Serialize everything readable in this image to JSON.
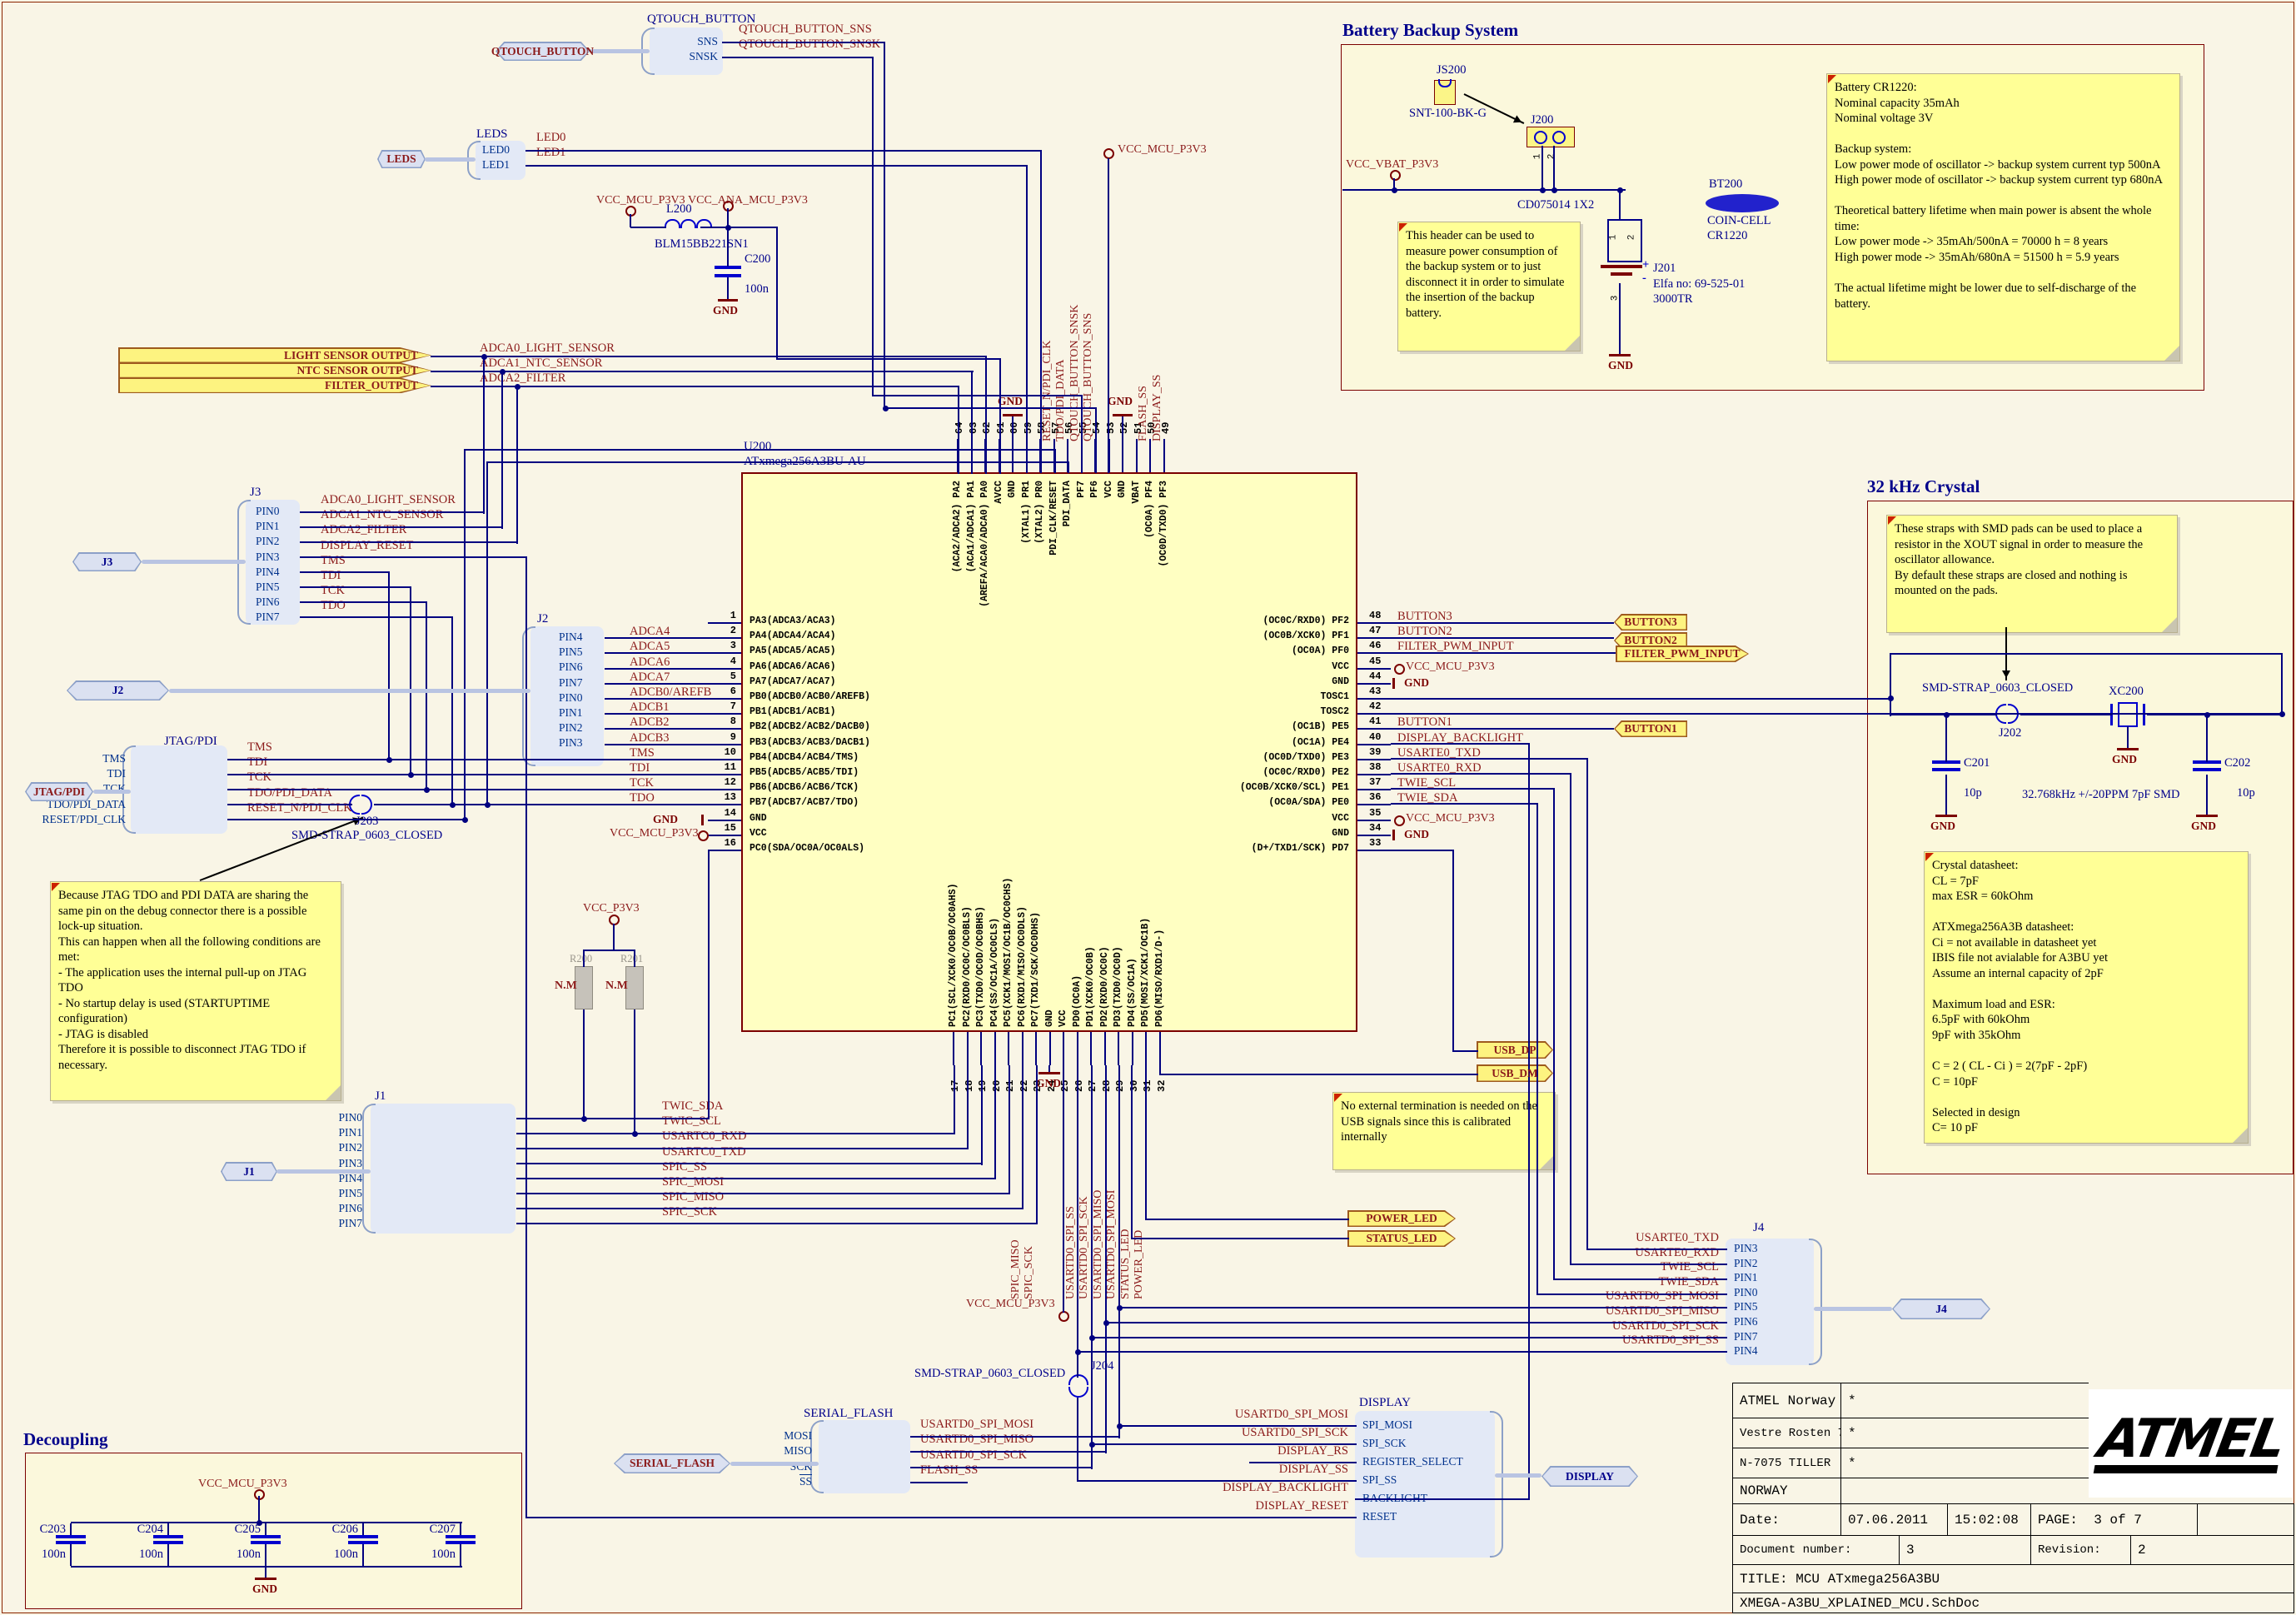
{
  "nets": {
    "vcc_mcu": "VCC_MCU_P3V3",
    "vcc_ana": "VCC_ANA_MCU_P3V3",
    "vcc_vbat": "VCC_VBAT_P3V3",
    "vcc_p3v3": "VCC_P3V3",
    "gnd": "GND",
    "qtouch_sns": "QTOUCH_BUTTON_SNS",
    "qtouch_snsk": "QTOUCH_BUTTON_SNSK",
    "led0": "LED0",
    "led1": "LED1"
  },
  "sections": {
    "battery_title": "Battery Backup System",
    "crystal_title": "32 kHz Crystal",
    "decoupling_title": "Decoupling"
  },
  "qtouch": {
    "port": "QTOUCH_BUTTON",
    "title": "QTOUCH_BUTTON",
    "rows": [
      {
        "pin": "SNS",
        "net": "QTOUCH_BUTTON_SNS"
      },
      {
        "pin": "SNSK",
        "net": "QTOUCH_BUTTON_SNSK"
      }
    ]
  },
  "leds": {
    "port": "LEDS",
    "title": "LEDS",
    "rows": [
      {
        "pin": "LED0",
        "net": "LED0"
      },
      {
        "pin": "LED1",
        "net": "LED1"
      }
    ]
  },
  "ana": {
    "l_ref": "L200",
    "l_val": "BLM15BB221SN1",
    "c_ref": "C200",
    "c_val": "100n"
  },
  "battery": {
    "js200_ref": "JS200",
    "js200_val": "SNT-100-BK-G",
    "j200_ref": "J200",
    "j200_val": "CD075014 1X2",
    "j200_p1": "1",
    "j200_p2": "2",
    "j201_ref": "J201",
    "j201_val1": "Elfa no: 69-525-01",
    "j201_val2": "3000TR",
    "j201_p1": "1",
    "j201_p2": "2",
    "j201_p3": "3",
    "plus": "+",
    "minus": "-",
    "bt200_ref": "BT200",
    "bt200_val1": "COIN-CELL",
    "bt200_val2": "CR1220",
    "note_header": "This header can be used to measure power consumption of the backup system or to just disconnect it in order to simulate the insertion of the backup battery.",
    "note_battery": "Battery CR1220:\nNominal capacity 35mAh\nNominal voltage 3V\n\nBackup system:\nLow power mode of oscillator -> backup system current typ 500nA\nHigh power mode of oscillator -> backup system current typ 680nA\n\nTheoretical battery lifetime when main power is absent the whole time:\nLow power mode -> 35mAh/500nA = 70000 h = 8 years\nHigh power mode -> 35mAh/680nA = 51500 h = 5.9 years\n\nThe actual lifetime might be lower due to self-discharge of the battery."
  },
  "sensor_ports": {
    "rows": [
      {
        "label": "LIGHT SENSOR OUTPUT",
        "net": "ADCA0_LIGHT_SENSOR"
      },
      {
        "label": "NTC SENSOR OUTPUT",
        "net": "ADCA1_NTC_SENSOR"
      },
      {
        "label": "FILTER_OUTPUT",
        "net": "ADCA2_FILTER"
      }
    ]
  },
  "j3": {
    "title": "J3",
    "port": "J3",
    "rows": [
      {
        "pin": "PIN0",
        "net": "ADCA0_LIGHT_SENSOR"
      },
      {
        "pin": "PIN1",
        "net": "ADCA1_NTC_SENSOR"
      },
      {
        "pin": "PIN2",
        "net": "ADCA2_FILTER"
      },
      {
        "pin": "PIN3",
        "net": "DISPLAY_RESET"
      },
      {
        "pin": "PIN4",
        "net": "TMS"
      },
      {
        "pin": "PIN5",
        "net": "TDI"
      },
      {
        "pin": "PIN6",
        "net": "TCK"
      },
      {
        "pin": "PIN7",
        "net": "TDO"
      }
    ]
  },
  "j2": {
    "title": "J2",
    "port": "J2",
    "rows": [
      {
        "pin": "PIN4"
      },
      {
        "pin": "PIN5"
      },
      {
        "pin": "PIN6"
      },
      {
        "pin": "PIN7"
      },
      {
        "pin": "PIN0"
      },
      {
        "pin": "PIN1"
      },
      {
        "pin": "PIN2"
      },
      {
        "pin": "PIN3"
      }
    ]
  },
  "jtag": {
    "title": "JTAG/PDI",
    "port": "JTAG/PDI",
    "strap_ref": "J203",
    "strap_val": "SMD-STRAP_0603_CLOSED",
    "rows": [
      {
        "pin": "TMS",
        "net": "TMS"
      },
      {
        "pin": "TDI",
        "net": "TDI"
      },
      {
        "pin": "TCK",
        "net": "TCK"
      },
      {
        "pin": "TDO/PDI_DATA",
        "net": "TDO/PDI_DATA"
      },
      {
        "pin": "RESET/PDI_CLK",
        "net": "RESET_N/PDI_CLK"
      }
    ],
    "note": "Because JTAG TDO and PDI DATA are sharing the same pin on the debug connector there is a possible lock-up situation.\nThis can happen when all the following conditions are met:\n- The application uses the internal pull-up on JTAG TDO\n- No startup delay is used (STARTUPTIME configuration)\n- JTAG is disabled\nTherefore it is possible to disconnect JTAG TDO if necessary."
  },
  "mcu": {
    "ref": "U200",
    "part": "ATxmega256A3BU-AU",
    "left_pins": [
      {
        "num": "1",
        "name": "PA3(ADCA3/ACA3)",
        "net": ""
      },
      {
        "num": "2",
        "name": "PA4(ADCA4/ACA4)",
        "net": "ADCA4"
      },
      {
        "num": "3",
        "name": "PA5(ADCA5/ACA5)",
        "net": "ADCA5"
      },
      {
        "num": "4",
        "name": "PA6(ADCA6/ACA6)",
        "net": "ADCA6"
      },
      {
        "num": "5",
        "name": "PA7(ADCA7/ACA7)",
        "net": "ADCA7"
      },
      {
        "num": "6",
        "name": "PB0(ADCB0/ACB0/AREFB)",
        "net": "ADCB0/AREFB"
      },
      {
        "num": "7",
        "name": "PB1(ADCB1/ACB1)",
        "net": "ADCB1"
      },
      {
        "num": "8",
        "name": "PB2(ADCB2/ACB2/DACB0)",
        "net": "ADCB2"
      },
      {
        "num": "9",
        "name": "PB3(ADCB3/ACB3/DACB1)",
        "net": "ADCB3"
      },
      {
        "num": "10",
        "name": "PB4(ADCB4/ACB4/TMS)",
        "net": "TMS"
      },
      {
        "num": "11",
        "name": "PB5(ADCB5/ACB5/TDI)",
        "net": "TDI"
      },
      {
        "num": "12",
        "name": "PB6(ADCB6/ACB6/TCK)",
        "net": "TCK"
      },
      {
        "num": "13",
        "name": "PB7(ADCB7/ACB7/TDO)",
        "net": "TDO"
      },
      {
        "num": "14",
        "name": "GND",
        "net": "GND",
        "sym": "gnd"
      },
      {
        "num": "15",
        "name": "VCC",
        "net": "VCC_MCU_P3V3",
        "sym": "vcc"
      },
      {
        "num": "16",
        "name": "PC0(SDA/OC0A/OC0ALS)",
        "net": ""
      }
    ],
    "right_pins": [
      {
        "num": "48",
        "name": "(OC0C/RXD0) PF2",
        "net": "BUTTON3"
      },
      {
        "num": "47",
        "name": "(OC0B/XCK0) PF1",
        "net": "BUTTON2"
      },
      {
        "num": "46",
        "name": "(OC0A) PF0",
        "net": "FILTER_PWM_INPUT"
      },
      {
        "num": "45",
        "name": "VCC",
        "net": "VCC_MCU_P3V3",
        "sym": "vcc"
      },
      {
        "num": "44",
        "name": "GND",
        "net": "GND",
        "sym": "gnd"
      },
      {
        "num": "43",
        "name": "TOSC1",
        "net": ""
      },
      {
        "num": "42",
        "name": "TOSC2",
        "net": ""
      },
      {
        "num": "41",
        "name": "(OC1B) PE5",
        "net": "BUTTON1"
      },
      {
        "num": "40",
        "name": "(OC1A) PE4",
        "net": "DISPLAY_BACKLIGHT"
      },
      {
        "num": "39",
        "name": "(OC0D/TXD0) PE3",
        "net": "USARTE0_TXD"
      },
      {
        "num": "38",
        "name": "(OC0C/RXD0) PE2",
        "net": "USARTE0_RXD"
      },
      {
        "num": "37",
        "name": "(OC0B/XCK0/SCL) PE1",
        "net": "TWIE_SCL"
      },
      {
        "num": "36",
        "name": "(OC0A/SDA) PE0",
        "net": "TWIE_SDA"
      },
      {
        "num": "35",
        "name": "VCC",
        "net": "VCC_MCU_P3V3",
        "sym": "vcc"
      },
      {
        "num": "34",
        "name": "GND",
        "net": "GND",
        "sym": "gnd"
      },
      {
        "num": "33",
        "name": "(D+/TXD1/SCK) PD7",
        "net": ""
      }
    ],
    "top_pins": [
      {
        "num": "64",
        "name": "(ACA2/ADCA2) PA2"
      },
      {
        "num": "63",
        "name": "(ACA1/ADCA1) PA1"
      },
      {
        "num": "62",
        "name": "(AREFA/ACA0/ADCA0) PA0"
      },
      {
        "num": "61",
        "name": "AVCC"
      },
      {
        "num": "60",
        "name": "GND"
      },
      {
        "num": "59",
        "name": "(XTAL1) PR1"
      },
      {
        "num": "58",
        "name": "(XTAL2) PR0"
      },
      {
        "num": "57",
        "name": "PDI_CLK/RESET"
      },
      {
        "num": "56",
        "name": "PDI_DATA"
      },
      {
        "num": "55",
        "name": "PF7"
      },
      {
        "num": "54",
        "name": "PF6"
      },
      {
        "num": "53",
        "name": "VCC"
      },
      {
        "num": "52",
        "name": "GND"
      },
      {
        "num": "51",
        "name": "VBAT"
      },
      {
        "num": "50",
        "name": "(OC0A) PF4"
      },
      {
        "num": "49",
        "name": "(OC0D/TXD0) PF3"
      }
    ],
    "bottom_pins": [
      {
        "num": "17",
        "name": "PC1(SCL/XCK0/OC0B/OC0AHS)"
      },
      {
        "num": "18",
        "name": "PC2(RXD0/OC0C/OC0BLS)"
      },
      {
        "num": "19",
        "name": "PC3(TXD0/OC0D/OC0BHS)"
      },
      {
        "num": "20",
        "name": "PC4(SS/OC1A/OC0CLS)"
      },
      {
        "num": "21",
        "name": "PC5(XCK1/MOSI/OC1B/OC0CHS)"
      },
      {
        "num": "22",
        "name": "PC6(RXD1/MISO/OC0DLS)"
      },
      {
        "num": "23",
        "name": "PC7(TXD1/SCK/OC0DHS)"
      },
      {
        "num": "24",
        "name": "GND"
      },
      {
        "num": "25",
        "name": "VCC"
      },
      {
        "num": "26",
        "name": "PD0(OC0A)"
      },
      {
        "num": "27",
        "name": "PD1(XCK0/OC0B)"
      },
      {
        "num": "28",
        "name": "PD2(RXD0/OC0C)"
      },
      {
        "num": "29",
        "name": "PD3(TXD0/OC0D)"
      },
      {
        "num": "30",
        "name": "PD4(SS/OC1A)"
      },
      {
        "num": "31",
        "name": "PD5(MOSI/XCK1/OC1B)"
      },
      {
        "num": "32",
        "name": "PD6(MISO/RXD1/D-)"
      }
    ],
    "top_nets": [
      {
        "net": "RESET_N/PDI_CLK",
        "col": 7
      },
      {
        "net": "TDO/PDI_DATA",
        "col": 8
      },
      {
        "net": "QTOUCH_BUTTON_SNSK",
        "col": 9
      },
      {
        "net": "QTOUCH_BUTTON_SNS",
        "col": 10
      },
      {
        "net": "FLASH_SS",
        "col": 14
      },
      {
        "net": "DISPLAY_SS",
        "col": 15
      }
    ],
    "bottom_nets": [
      {
        "net": "SPIC_MISO",
        "col": 5
      },
      {
        "net": "SPIC_SCK",
        "col": 6
      },
      {
        "net": "USARTD0_SPI_SS",
        "col": 9
      },
      {
        "net": "USARTD0_SPI_SCK",
        "col": 10
      },
      {
        "net": "USARTD0_SPI_MISO",
        "col": 11
      },
      {
        "net": "USARTD0_SPI_MOSI",
        "col": 12
      },
      {
        "net": "STATUS_LED",
        "col": 13
      },
      {
        "net": "POWER_LED",
        "col": 14
      }
    ]
  },
  "right_ports": {
    "button3": "BUTTON3",
    "button2": "BUTTON2",
    "filter": "FILTER_PWM_INPUT",
    "button1": "BUTTON1"
  },
  "crystal": {
    "note_straps": "These straps with SMD pads can be used to place a resistor in the XOUT signal in order to measure the oscillator allowance.\nBy default these straps are closed and nothing is mounted on the pads.",
    "strap_val": "SMD-STRAP_0603_CLOSED",
    "strap_ref": "J202",
    "xtal_ref": "XC200",
    "xtal_val": "32.768kHz +/-20PPM 7pF  SMD",
    "c201_ref": "C201",
    "c201_val": "10p",
    "c202_ref": "C202",
    "c202_val": "10p",
    "note_datasheet": "Crystal datasheet:\nCL = 7pF\nmax ESR = 60kOhm\n\nATXmega256A3B datasheet:\nCi = not available in datasheet yet\nIBIS file not avialable for A3BU yet\nAssume an internal capacity of 2pF\n\nMaximum load and ESR:\n6.5pF with 60kOhm\n9pF with 35kOhm\n\nC = 2 ( CL - Ci ) = 2(7pF - 2pF)\nC = 10pF\n\nSelected in design\nC= 10 pF"
  },
  "usb": {
    "dp": "USB_DP",
    "dm": "USB_DM",
    "note": "No external termination is needed on the USB signals since this is calibrated internally"
  },
  "led_ports": {
    "power": "POWER_LED",
    "status": "STATUS_LED"
  },
  "j4": {
    "title": "J4",
    "port": "J4",
    "rows": [
      {
        "net": "USARTE0_TXD",
        "pin": "PIN3"
      },
      {
        "net": "USARTE0_RXD",
        "pin": "PIN2"
      },
      {
        "net": "TWIE_SCL",
        "pin": "PIN1"
      },
      {
        "net": "TWIE_SDA",
        "pin": "PIN0"
      },
      {
        "net": "USARTD0_SPI_MOSI",
        "pin": "PIN5"
      },
      {
        "net": "USARTD0_SPI_MISO",
        "pin": "PIN6"
      },
      {
        "net": "USARTD0_SPI_SCK",
        "pin": "PIN7"
      },
      {
        "net": "USARTD0_SPI_SS",
        "pin": "PIN4"
      }
    ]
  },
  "serial_flash": {
    "title": "SERIAL_FLASH",
    "port": "SERIAL_FLASH",
    "strap_ref": "J204",
    "strap_val": "SMD-STRAP_0603_CLOSED",
    "rows": [
      {
        "pin": "MOSI",
        "net": "USARTD0_SPI_MOSI"
      },
      {
        "pin": "MISO",
        "net": "USARTD0_SPI_MISO"
      },
      {
        "pin": "SCK",
        "net": "USARTD0_SPI_SCK"
      },
      {
        "pin": "SS",
        "net": "FLASH_SS",
        "bar": true
      }
    ]
  },
  "display": {
    "title": "DISPLAY",
    "port": "DISPLAY",
    "rows": [
      {
        "pin": "SPI_MOSI",
        "net": "USARTD0_SPI_MOSI"
      },
      {
        "pin": "SPI_SCK",
        "net": "USARTD0_SPI_SCK"
      },
      {
        "pin": "REGISTER_SELECT",
        "net": "DISPLAY_RS"
      },
      {
        "pin": "SPI_SS",
        "net": "DISPLAY_SS"
      },
      {
        "pin": "BACKLIGHT",
        "net": "DISPLAY_BACKLIGHT"
      },
      {
        "pin": "RESET",
        "net": "DISPLAY_RESET"
      }
    ]
  },
  "j1": {
    "title": "J1",
    "port": "J1",
    "rows": [
      {
        "pin": "PIN0",
        "net": "TWIC_SDA"
      },
      {
        "pin": "PIN1",
        "net": "TWIC_SCL"
      },
      {
        "pin": "PIN2",
        "net": "USARTC0_RXD"
      },
      {
        "pin": "PIN3",
        "net": "USARTC0_TXD"
      },
      {
        "pin": "PIN4",
        "net": "SPIC_SS"
      },
      {
        "pin": "PIN5",
        "net": "SPIC_MOSI"
      },
      {
        "pin": "PIN6",
        "net": "SPIC_MISO"
      },
      {
        "pin": "PIN7",
        "net": "SPIC_SCK"
      }
    ]
  },
  "decoupling": {
    "caps": [
      {
        "ref": "C203",
        "val": "100n"
      },
      {
        "ref": "C204",
        "val": "100n"
      },
      {
        "ref": "C205",
        "val": "100n"
      },
      {
        "ref": "C206",
        "val": "100n"
      },
      {
        "ref": "C207",
        "val": "100n"
      }
    ]
  },
  "nm": {
    "r200": "R200",
    "r201": "R201",
    "nm": "N.M"
  },
  "titleblock": {
    "company": "ATMEL Norway",
    "addr": "Vestre Rosten 79",
    "city": "N-7075 TILLER",
    "country": "NORWAY",
    "star": "*",
    "date_label": "Date:",
    "date": "07.06.2011",
    "time": "15:02:08",
    "page_label": "PAGE:",
    "page": "3  of  7",
    "doc_label": "Document number:",
    "doc": "3",
    "rev_label": "Revision:",
    "rev": "2",
    "title": "TITLE: MCU ATxmega256A3BU",
    "file": "XMEGA-A3BU_XPLAINED_MCU.SchDoc",
    "logo": "ATMEL"
  }
}
